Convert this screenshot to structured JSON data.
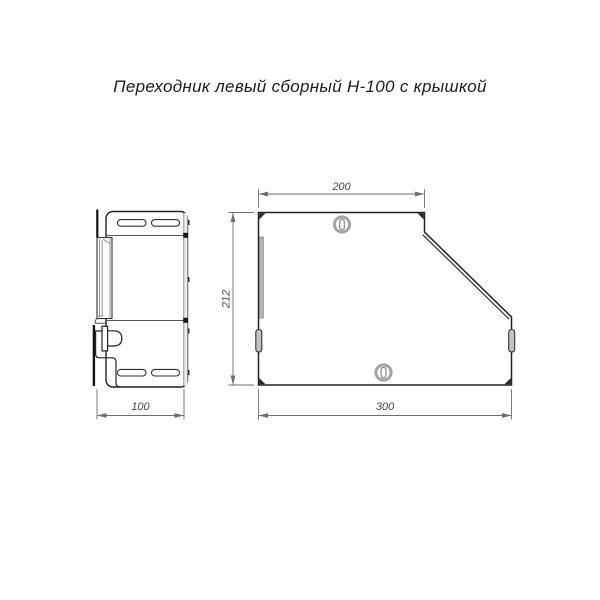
{
  "title": "Переходник левый сборный Н-100 с крышкой",
  "views": {
    "side": {
      "name": "side-profile-view",
      "dim_width": "100"
    },
    "front": {
      "name": "front-view",
      "dim_top": "200",
      "dim_height": "212",
      "dim_bottom": "300"
    }
  },
  "symbols": {
    "screw_top": "screw-head-symbol",
    "screw_bottom": "screw-head-symbol"
  },
  "colors": {
    "outline": "#222222",
    "dimension": "#6e6e6e",
    "text": "#1c1c1c",
    "gray_fill": "#b5b5b5",
    "background": "#ffffff"
  }
}
